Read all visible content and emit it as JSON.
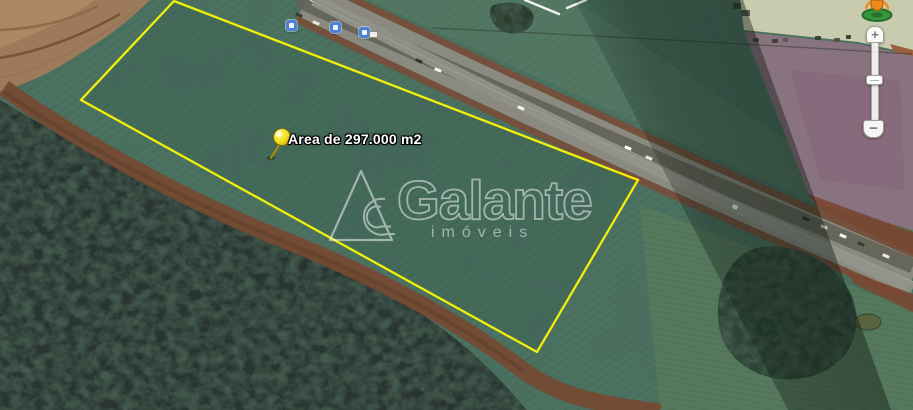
{
  "map": {
    "placemark_label": "Area de 297.000 m2",
    "colors": {
      "parcel_outline": "#F0F00A",
      "pin_head": "#F2DE1C",
      "shield_blue": "#4A80D8",
      "pegman_orange": "#F08A1D",
      "pegman_base_green": "#37953C"
    },
    "icons": {
      "pushpin": "pushpin-icon",
      "road_shield": "road-shield-icon",
      "pegman": "pegman-icon",
      "zoom_in": "plus-icon",
      "zoom_out": "minus-icon"
    }
  },
  "watermark": {
    "brand": "Galante",
    "tagline": "imóveis"
  },
  "zoom_control": {
    "zoom_in": "+",
    "zoom_out": "−"
  }
}
